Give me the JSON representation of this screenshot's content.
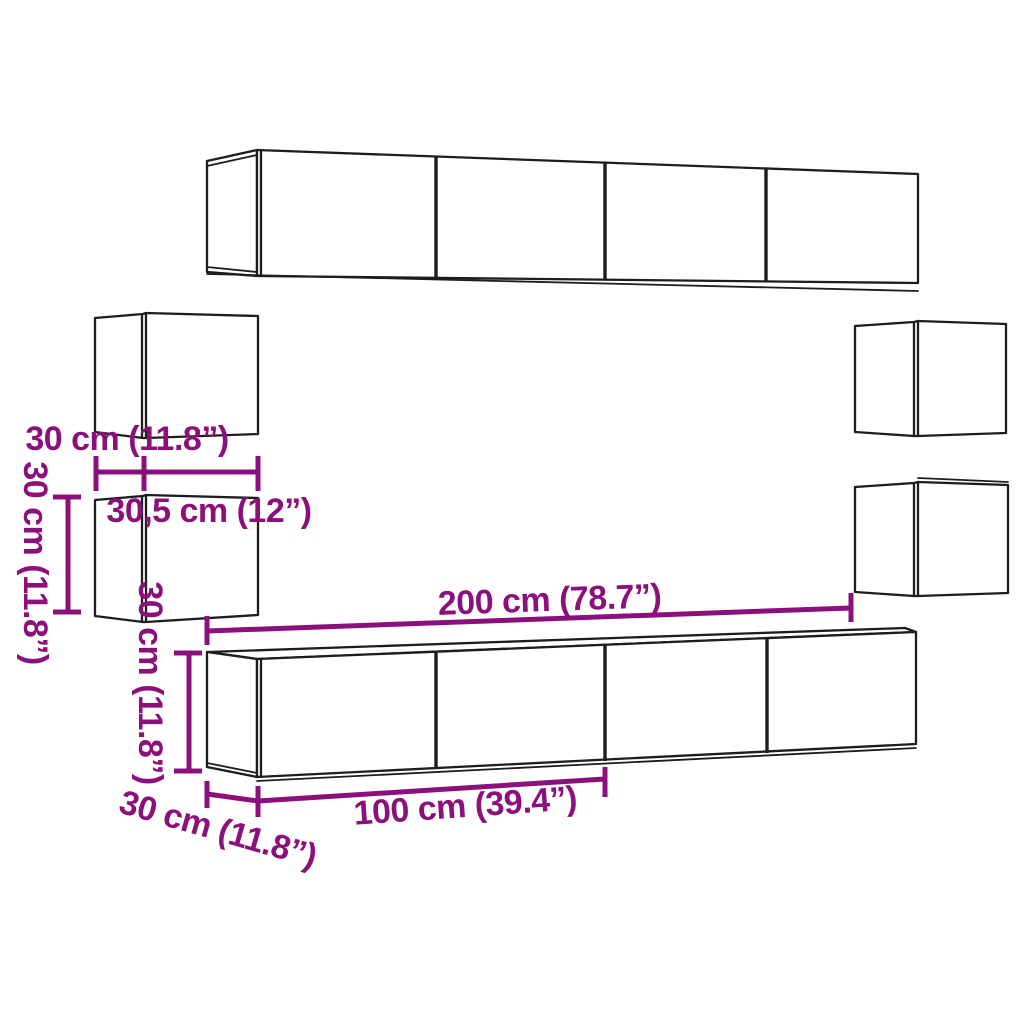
{
  "colors": {
    "dimension_magenta": "#8c107c",
    "line_black": "#1d1d1d",
    "background": "#ffffff"
  },
  "dimension_labels": {
    "left_cabinet_side_depth": "30 cm (11.8”)",
    "left_cabinet_front_width": "30,5 cm (12”)",
    "left_cabinet_height": "30 cm (11.8”)",
    "tv_cabinet_height": "30 cm (11.8”)",
    "tv_cabinet_total_length": "200 cm (78.7”)",
    "tv_cabinet_module_length": "100 cm (39.4”)",
    "tv_cabinet_depth": "30 cm (11.8”)"
  }
}
